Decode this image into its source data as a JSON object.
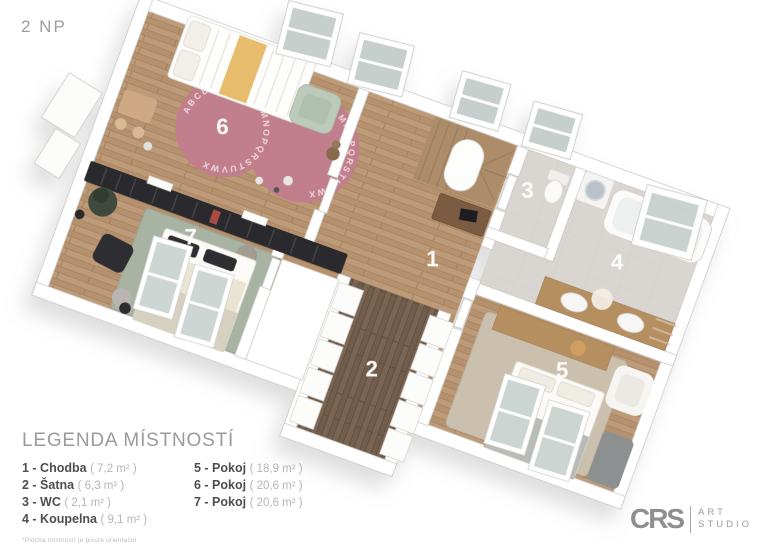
{
  "page": {
    "floor_label": "2 NP"
  },
  "legend": {
    "title": "LEGENDA MÍSTNOSTÍ",
    "items": [
      {
        "label": "1 - Chodba",
        "area": "( 7,2 m² )"
      },
      {
        "label": "2 - Šatna",
        "area": "( 6,3 m² )"
      },
      {
        "label": "3 - WC",
        "area": "( 2,1 m² )"
      },
      {
        "label": "4 - Koupelna",
        "area": "( 9,1 m² )"
      },
      {
        "label": "5 - Pokoj",
        "area": "( 18,9 m² )"
      },
      {
        "label": "6 - Pokoj",
        "area": "( 20,6 m² )"
      },
      {
        "label": "7 - Pokoj",
        "area": "( 20,6 m² )"
      }
    ],
    "footnote": "*Plocha místností je pouze orientační"
  },
  "floorplan": {
    "room_labels": [
      "1",
      "2",
      "3",
      "4",
      "5",
      "6",
      "7"
    ],
    "rug_alphabet": "ABCDEFGHIJKLMNOPQRSTUVWX",
    "colors": {
      "wood_floor": "#b5916e",
      "dark_wood_floor": "#715d4b",
      "tile_floor": "#d9d5d1",
      "pink_rug": "#c17e8d",
      "sage_rug": "#a8b3a4",
      "beige_rug": "#cbc0ae",
      "wall": "#ffffff",
      "shelf": "#2c2c2e"
    }
  },
  "logo": {
    "brand": "CRS",
    "line1": "ART",
    "line2": "STUDIO"
  }
}
